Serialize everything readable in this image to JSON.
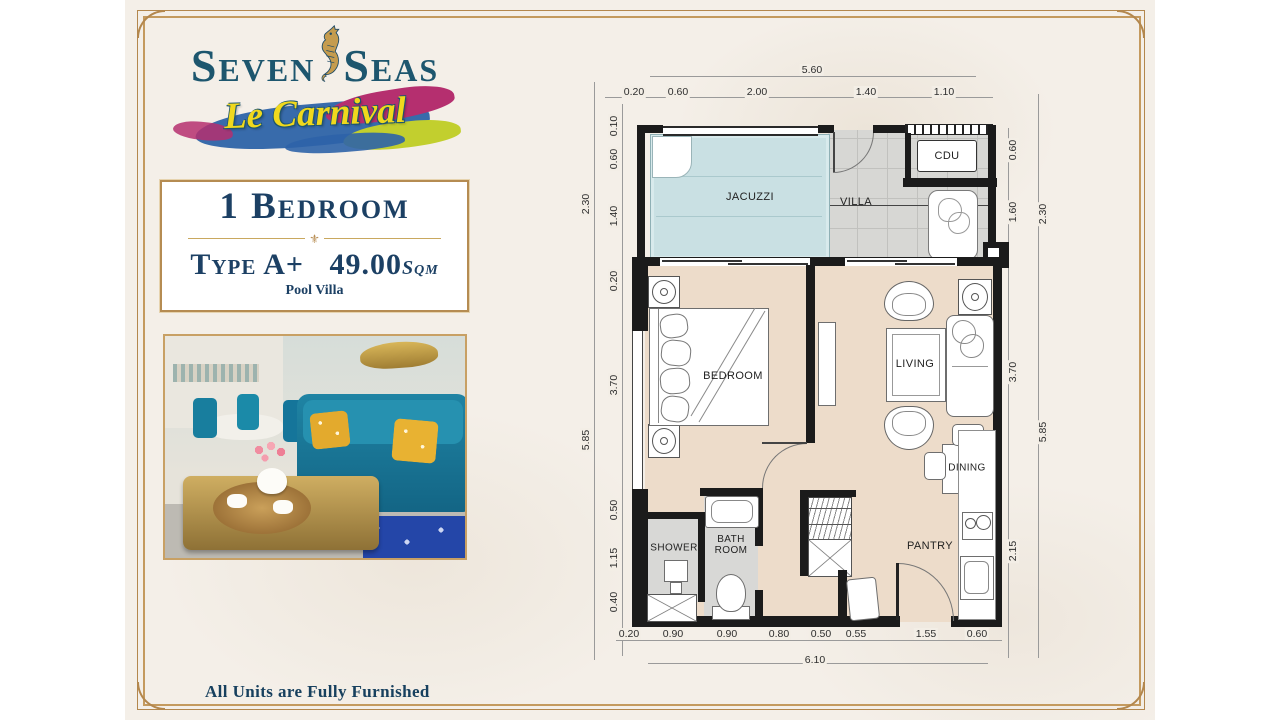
{
  "colors": {
    "accent_gold": "#b58c52",
    "navy_text": "#1c4064",
    "brand_teal": "#1d566e",
    "carnival_yellow": "#f0d81d",
    "cream_bg": "#f4efe8",
    "wall_black": "#1b1b1b",
    "jacuzzi_blue": "#c9e0e3",
    "floor_beige": "#eddcca",
    "tile_gray": "#d7d7d4"
  },
  "logo": {
    "brand_first": "Seven",
    "brand_second": "Seas",
    "sub_brand": "Le Carnival",
    "seahorse_icon": "seahorse"
  },
  "unit_info": {
    "title": "1 Bedroom",
    "divider_ornament": "⚜",
    "type_label": "Type A+",
    "area_value": "49.00",
    "area_unit": "Sqm",
    "subtitle": "Pool Villa"
  },
  "footer": {
    "note": "All Units are Fully Furnished"
  },
  "floor_plan": {
    "room_labels": [
      {
        "text": "JACUZZI",
        "x": 750,
        "y": 197,
        "size": 11
      },
      {
        "text": "VILLA",
        "x": 856,
        "y": 202,
        "size": 11
      },
      {
        "text": "CDU",
        "x": 947,
        "y": 156,
        "size": 11
      },
      {
        "text": "BEDROOM",
        "x": 733,
        "y": 376,
        "size": 11
      },
      {
        "text": "LIVING",
        "x": 915,
        "y": 364,
        "size": 11
      },
      {
        "text": "DINING",
        "x": 967,
        "y": 468,
        "size": 10
      },
      {
        "text": "SHOWER",
        "x": 674,
        "y": 548,
        "size": 10
      },
      {
        "text": "BATH\nROOM",
        "x": 731,
        "y": 545,
        "size": 10
      },
      {
        "text": "PANTRY",
        "x": 930,
        "y": 546,
        "size": 11
      }
    ],
    "dim_labels": [
      {
        "text": "5.60",
        "x": 812,
        "y": 70,
        "rot": 0
      },
      {
        "text": "0.20",
        "x": 634,
        "y": 92,
        "rot": 0
      },
      {
        "text": "0.60",
        "x": 678,
        "y": 92,
        "rot": 0
      },
      {
        "text": "2.00",
        "x": 757,
        "y": 92,
        "rot": 0
      },
      {
        "text": "1.40",
        "x": 866,
        "y": 92,
        "rot": 0
      },
      {
        "text": "1.10",
        "x": 944,
        "y": 92,
        "rot": 0
      },
      {
        "text": "0.10",
        "x": 614,
        "y": 126,
        "rot": -90
      },
      {
        "text": "0.60",
        "x": 614,
        "y": 159,
        "rot": -90
      },
      {
        "text": "1.40",
        "x": 614,
        "y": 216,
        "rot": -90
      },
      {
        "text": "0.20",
        "x": 614,
        "y": 281,
        "rot": -90
      },
      {
        "text": "3.70",
        "x": 614,
        "y": 385,
        "rot": -90
      },
      {
        "text": "0.50",
        "x": 614,
        "y": 510,
        "rot": -90
      },
      {
        "text": "1.15",
        "x": 614,
        "y": 558,
        "rot": -90
      },
      {
        "text": "0.40",
        "x": 614,
        "y": 602,
        "rot": -90
      },
      {
        "text": "2.30",
        "x": 586,
        "y": 204,
        "rot": -90
      },
      {
        "text": "5.85",
        "x": 586,
        "y": 440,
        "rot": -90
      },
      {
        "text": "0.60",
        "x": 1013,
        "y": 150,
        "rot": -90
      },
      {
        "text": "1.60",
        "x": 1013,
        "y": 212,
        "rot": -90
      },
      {
        "text": "3.70",
        "x": 1013,
        "y": 372,
        "rot": -90
      },
      {
        "text": "2.15",
        "x": 1013,
        "y": 551,
        "rot": -90
      },
      {
        "text": "2.30",
        "x": 1043,
        "y": 214,
        "rot": -90
      },
      {
        "text": "5.85",
        "x": 1043,
        "y": 432,
        "rot": -90
      },
      {
        "text": "0.20",
        "x": 629,
        "y": 634,
        "rot": 0
      },
      {
        "text": "0.90",
        "x": 673,
        "y": 634,
        "rot": 0
      },
      {
        "text": "0.90",
        "x": 727,
        "y": 634,
        "rot": 0
      },
      {
        "text": "0.80",
        "x": 779,
        "y": 634,
        "rot": 0
      },
      {
        "text": "0.50",
        "x": 821,
        "y": 634,
        "rot": 0
      },
      {
        "text": "0.55",
        "x": 856,
        "y": 634,
        "rot": 0
      },
      {
        "text": "1.55",
        "x": 926,
        "y": 634,
        "rot": 0
      },
      {
        "text": "0.60",
        "x": 977,
        "y": 634,
        "rot": 0
      },
      {
        "text": "6.10",
        "x": 815,
        "y": 660,
        "rot": 0
      }
    ]
  }
}
